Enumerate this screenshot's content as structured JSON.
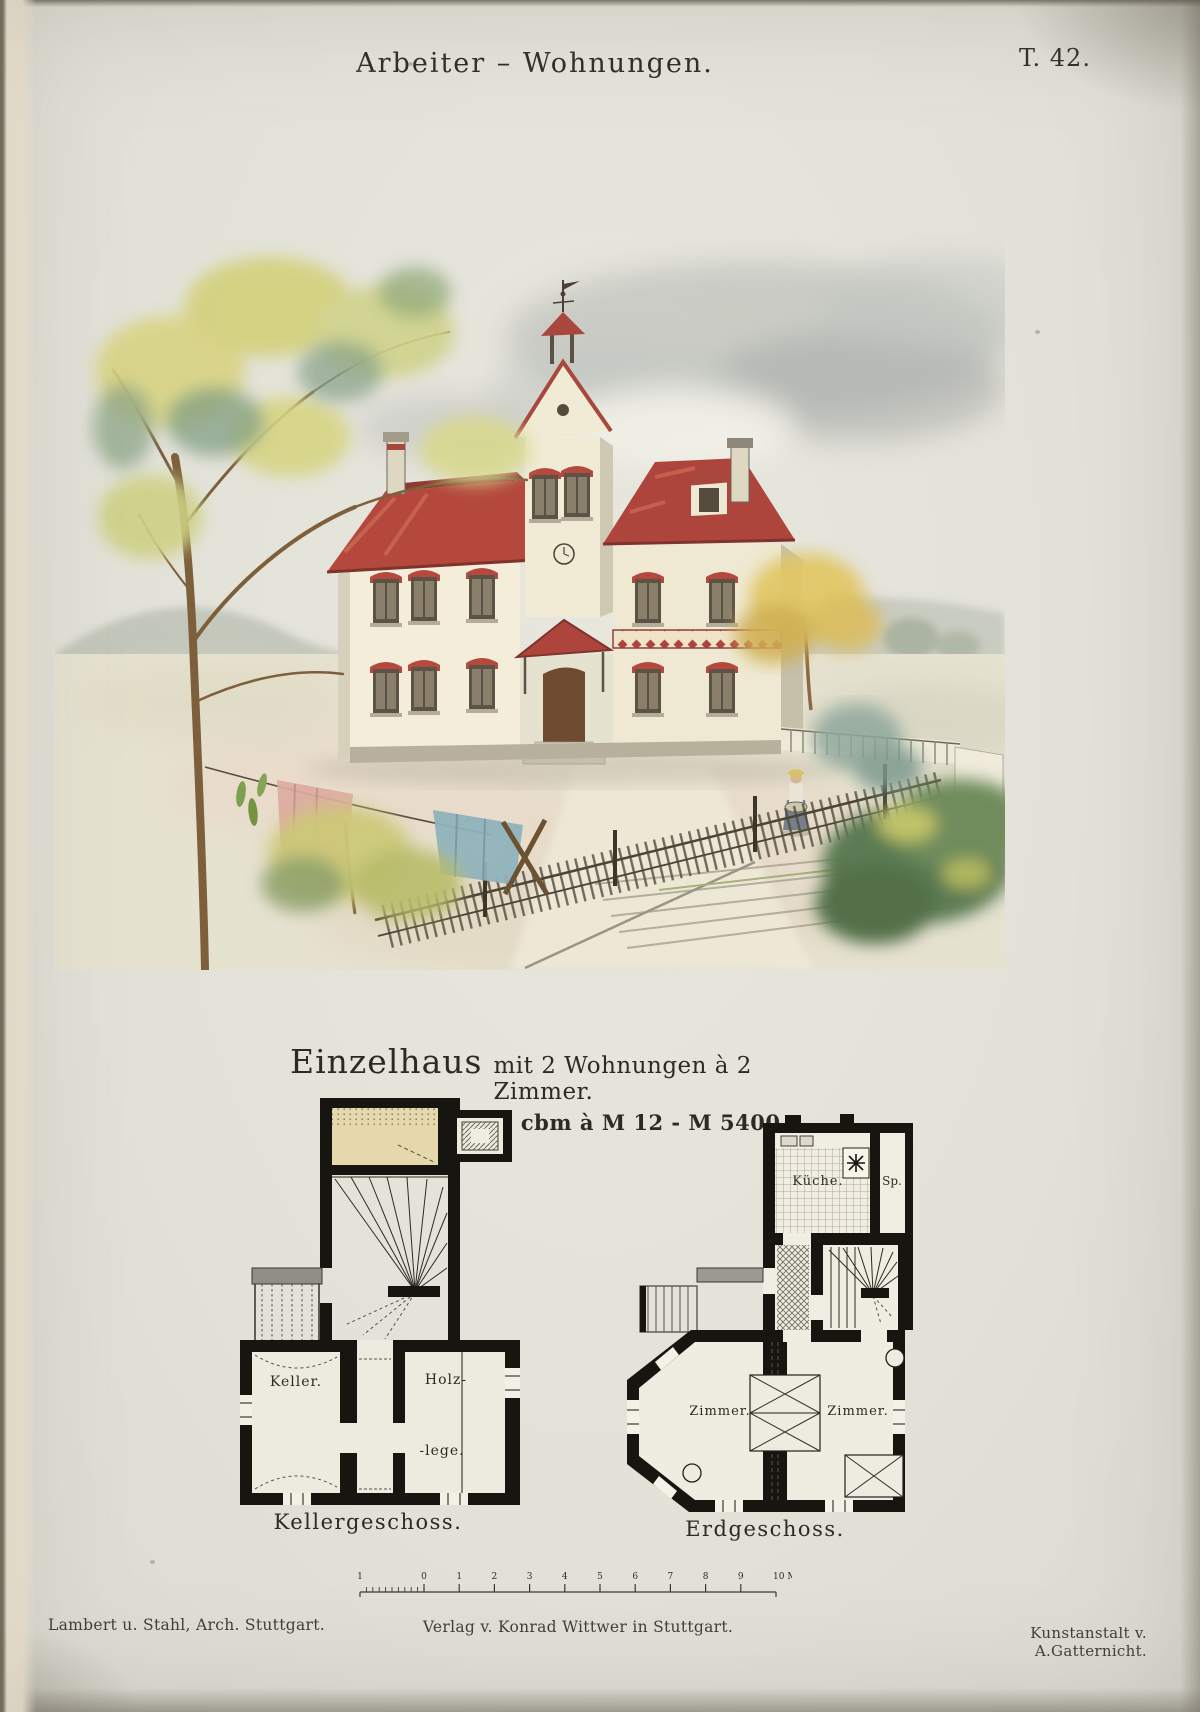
{
  "page": {
    "title": "Arbeiter – Wohnungen.",
    "plate_number": "T. 42."
  },
  "subtitle": {
    "main": "Einzelhaus",
    "rest": "mit 2 Wohnungen à 2 Zimmer."
  },
  "cost_line": "450 cbm à M 12 - M 5400.",
  "illustration": {
    "description": "Watercolour perspective view of a two-storey dwelling with red roofs, central tower with weathervane, picket fence, garden trees, clothesline with laundry and a woman with a wash tub"
  },
  "plans": {
    "basement": {
      "caption": "Kellergeschoss.",
      "rooms": {
        "keller": "Keller.",
        "holz_line1": "Holz-",
        "holz_line2": "-lege."
      }
    },
    "ground": {
      "caption": "Erdgeschoss.",
      "rooms": {
        "kitchen": "Küche.",
        "pantry": "Sp.",
        "room_left": "Zimmer.",
        "room_right": "Zimmer."
      }
    }
  },
  "scale_bar": {
    "left_labels": [
      "1",
      "0"
    ],
    "tick_labels": [
      "1",
      "2",
      "3",
      "4",
      "5",
      "6",
      "7",
      "8",
      "9"
    ],
    "end_label": "10 Met."
  },
  "footer": {
    "left": "Lambert u. Stahl, Arch. Stuttgart.",
    "center": "Verlag v. Konrad Wittwer in Stuttgart.",
    "right": "Kunstanstalt v. A.Gatternicht."
  },
  "colors": {
    "paper": "#e4e3da",
    "roof_red": "#b0453c",
    "wall_cream": "#f2ecd8",
    "foliage_yellow": "#d6d37e",
    "plan_wall_black": "#17150f",
    "room_beige": "#e6d8ad"
  }
}
